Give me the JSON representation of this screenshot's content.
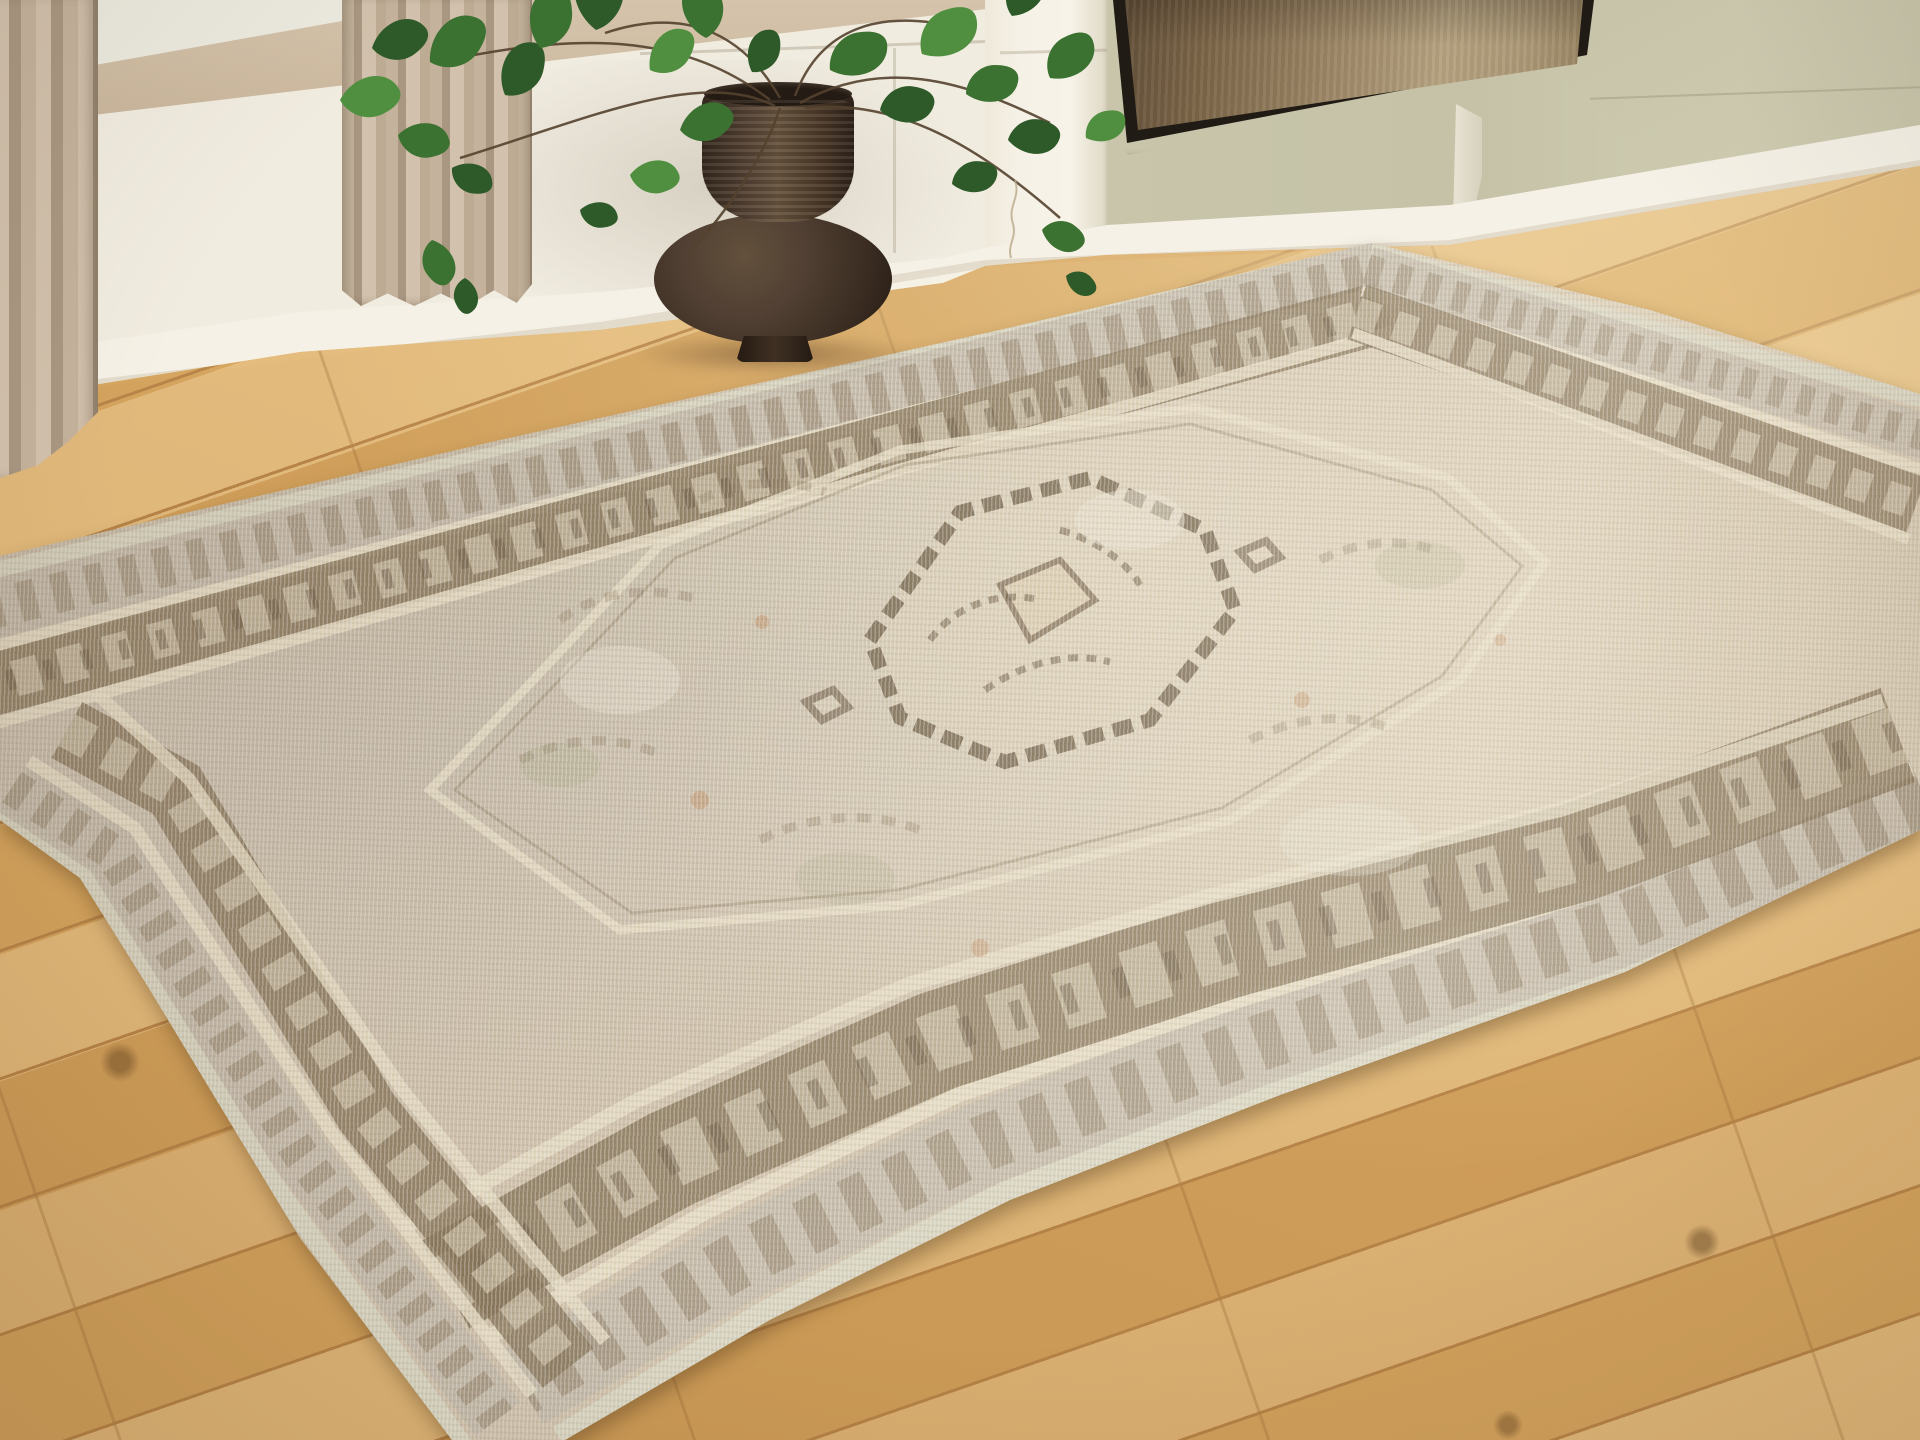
{
  "scene": {
    "description": "Interior product photo of a faded vintage-style medallion area rug laid diagonally on a light oak plank floor",
    "room": {
      "wall_left": "cream paneled wainscot wall with tan band above",
      "wall_right": "sage green wall section with white baseboard",
      "pilaster": "white square column between wall sections",
      "artwork": "large abstract canvas in thin black float frame, bronze-brown gradient, hung on sage wall, cropped by top edge",
      "curtains": "two tan linen curtain panels at left",
      "plant": "philodendron with heart-shaped green leaves in a dark brown gourd-shaped ceramic vase on the floor",
      "floor": "white-oak hardwood planks running diagonally",
      "rug": "distressed Persian-style rug with central stepped diamond medallion, layered geometric borders in brown, tan, cream, rust and faded green"
    }
  },
  "palette": {
    "wall_cream": "#f1ece0",
    "wall_tan": "#d5c3ab",
    "wall_sage": "#c8c5aa",
    "baseboard": "#f5f1e6",
    "floor_light": "#e4bc7e",
    "floor_mid": "#d6a660",
    "floor_dark": "#d2a15c",
    "floor_seam": "#b9864a",
    "curtain_light": "#d2c1ac",
    "curtain_mid": "#c4b29c",
    "curtain_dark": "#a99781",
    "leaf_dark": "#2d5a28",
    "leaf_mid": "#3c7231",
    "leaf_light": "#4f8f3f",
    "stem": "#54422e",
    "vase_dark": "#3a2c21",
    "vase_mid": "#514033",
    "vase_highlight": "#63503c",
    "art_frame": "#201b15",
    "art_left": "#5f4c36",
    "art_mid": "#9c8666",
    "art_right": "#b5a280",
    "rug_base": "#cfc1ab",
    "rug_cream": "#e6dcc4",
    "rug_tan": "#c1b7a8",
    "rug_brown": "#87755a",
    "rug_dark_brown": "#6d5c45",
    "rug_rust": "#b97a48",
    "rug_green": "#9fa379",
    "rug_selvage": "#d6d2be",
    "rug_shadow": "rgba(96,66,30,0.45)",
    "shadow_warm": "rgba(70,45,25,0.45)"
  }
}
